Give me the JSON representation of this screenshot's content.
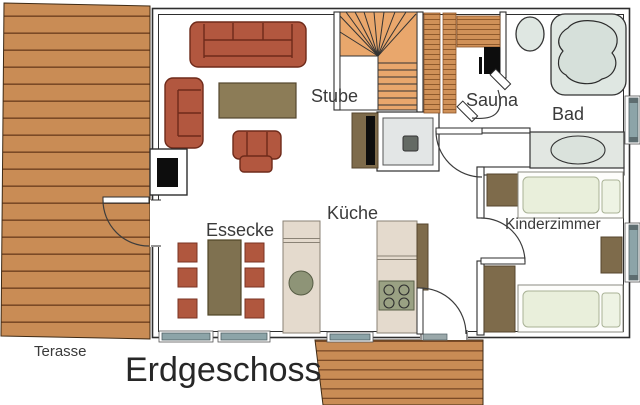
{
  "floor": {
    "label": "Erdgeschoss"
  },
  "terrace": {
    "label": "Terasse"
  },
  "rooms": {
    "stube": {
      "label": "Stube"
    },
    "sauna": {
      "label": "Sauna"
    },
    "bad": {
      "label": "Bad"
    },
    "essecke": {
      "label": "Essecke"
    },
    "kueche": {
      "label": "Küche"
    },
    "kinderzimmer": {
      "label": "Kinderzimmer"
    }
  },
  "palette": {
    "deck_wood": "#c98c55",
    "deck_plank_line": "#7b4a26",
    "stair_wood": "#e9a76c",
    "sauna_wood": "#d09158",
    "upholstery_red": "#b2573f",
    "furniture_brown": "#7e6b4b",
    "table_khaki": "#8c7c57",
    "dining_table": "#7f7150",
    "bed_green": "#e9efdb",
    "fixture_gray": "#dfe7e2",
    "appliance_green": "#8e9477",
    "window_teal": "#8ca4a8",
    "wall_line": "#2e2e2e",
    "heater_black": "#0d0d0d"
  }
}
